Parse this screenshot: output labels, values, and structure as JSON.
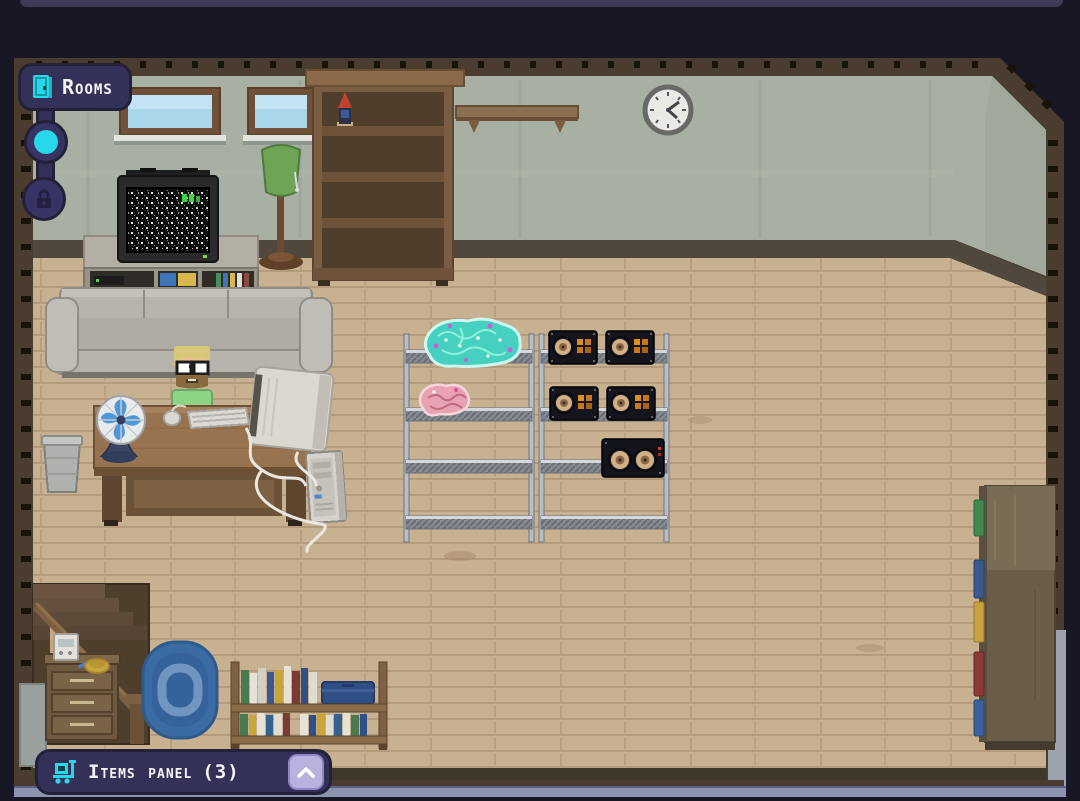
{
  "ui": {
    "rooms_button": {
      "label": "Rooms",
      "icon": "door-icon"
    },
    "room_nav": {
      "nodes": [
        {
          "id": "current-room",
          "state": "active",
          "icon": "filled-circle"
        },
        {
          "id": "locked-room",
          "state": "locked",
          "icon": "lock-icon"
        }
      ]
    },
    "items_panel": {
      "label": "Items panel",
      "count": "(3)",
      "icon": "cart-icon",
      "collapse_icon": "chevron-up"
    }
  },
  "colors": {
    "background": "#181726",
    "panel": "#343158",
    "panel_border": "#232138",
    "accent_cyan": "#29d8e8",
    "collapse_button": "#b8b2de",
    "room_frame": "#4a3d2f",
    "wall": "#a7b0a2",
    "floor": "#c7b190",
    "text": "#f4f4f6"
  },
  "scene": {
    "room": "basement den",
    "objects": [
      "window",
      "window",
      "tall-bookshelf",
      "wine-bottle",
      "wall-shelf",
      "wall-clock",
      "crt-tv",
      "tv-stand",
      "floor-lamp",
      "couch",
      "character",
      "desk",
      "desk-fan",
      "keyboard",
      "mouse",
      "crt-monitor",
      "pc-tower",
      "cables",
      "trash-bin",
      "metal-shelving-unit",
      "metal-shelving-unit",
      "teal-brain",
      "pink-brain",
      "speaker",
      "speaker",
      "speaker",
      "speaker",
      "double-speaker",
      "staircase",
      "drawer-chest",
      "radio",
      "pen",
      "bowl",
      "rug",
      "low-bookshelf",
      "blue-case",
      "side-cabinet"
    ]
  }
}
